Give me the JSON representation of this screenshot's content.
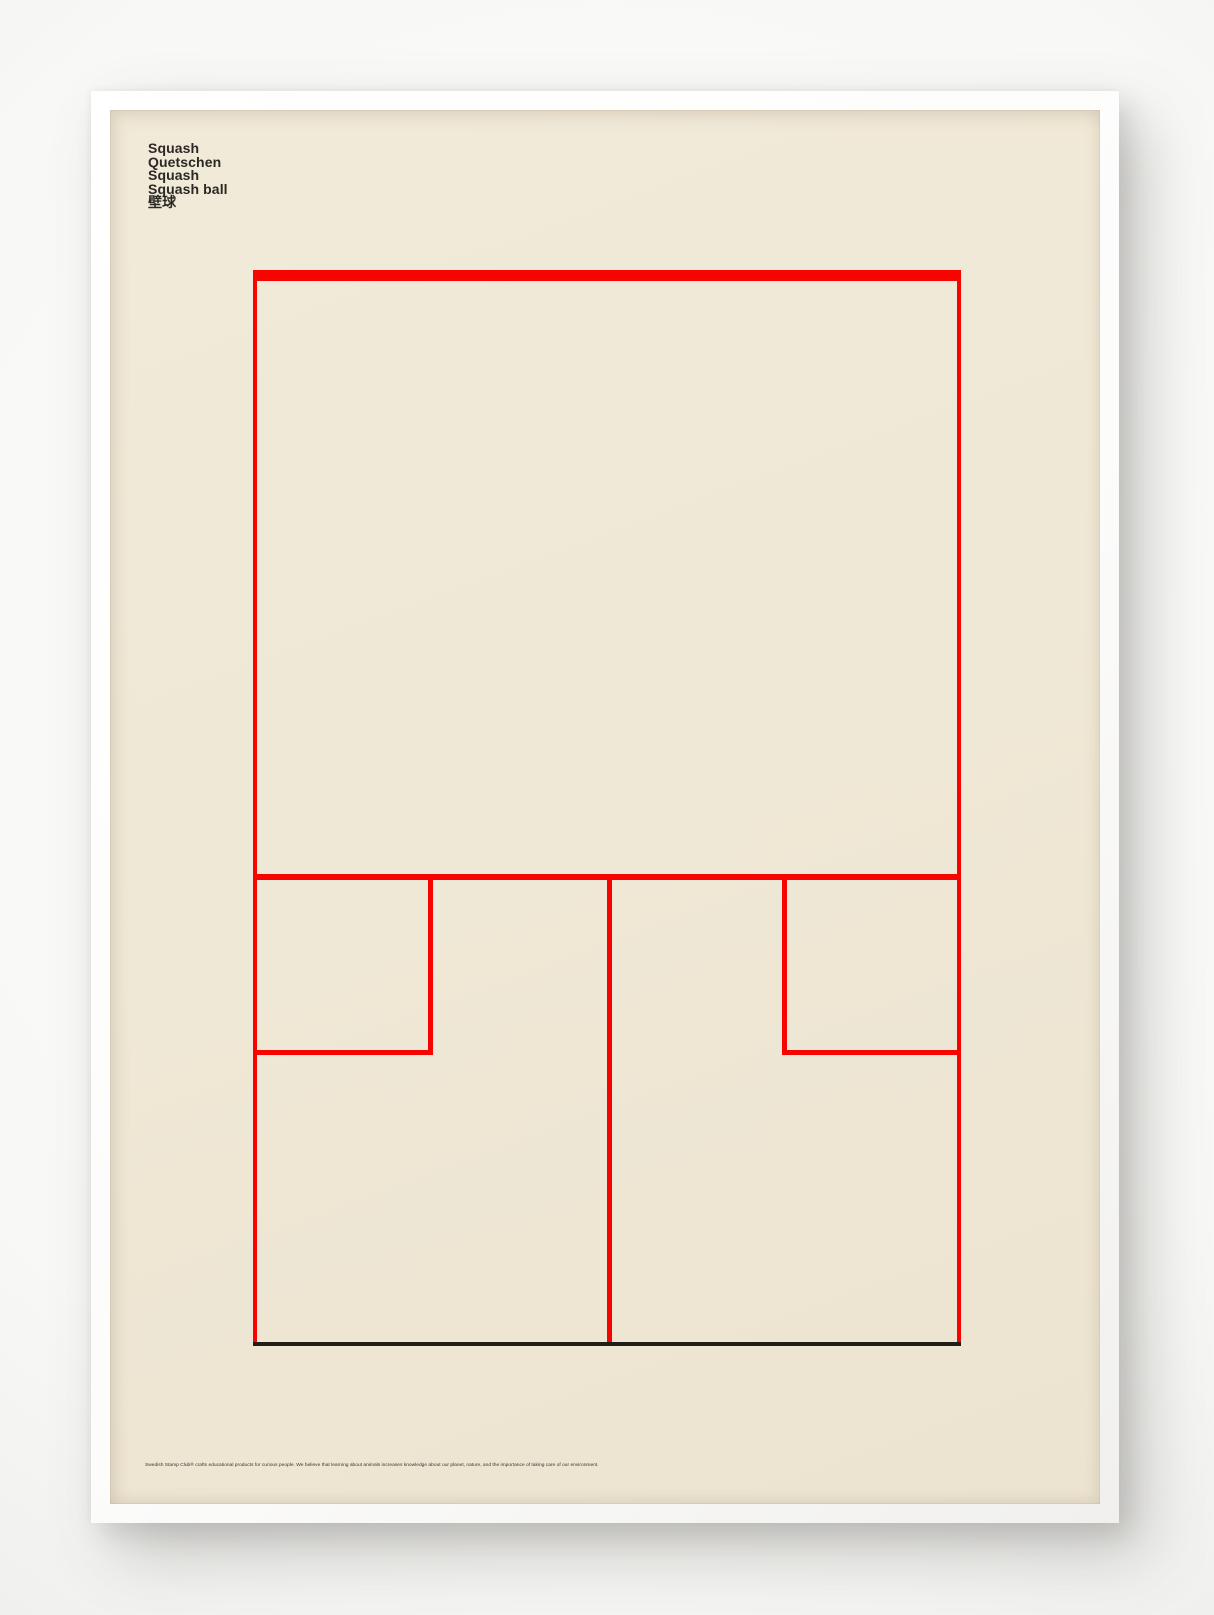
{
  "poster": {
    "title_lines": [
      "Squash",
      "Quetschen",
      "Squash",
      "Squash ball",
      "壁球"
    ],
    "footer_text": "Swedish Stamp Club® crafts educational products for curious people. We believe that learning about animals increases knowledge about our planet, nature, and the importance of taking care of our environment.",
    "diagram": "squash-court"
  },
  "colors": {
    "paper": "#f0e8d6",
    "court-red": "#f50400",
    "court-black": "#201d1a",
    "title-ink": "#2b2924",
    "footer-ink": "#3a372f"
  }
}
